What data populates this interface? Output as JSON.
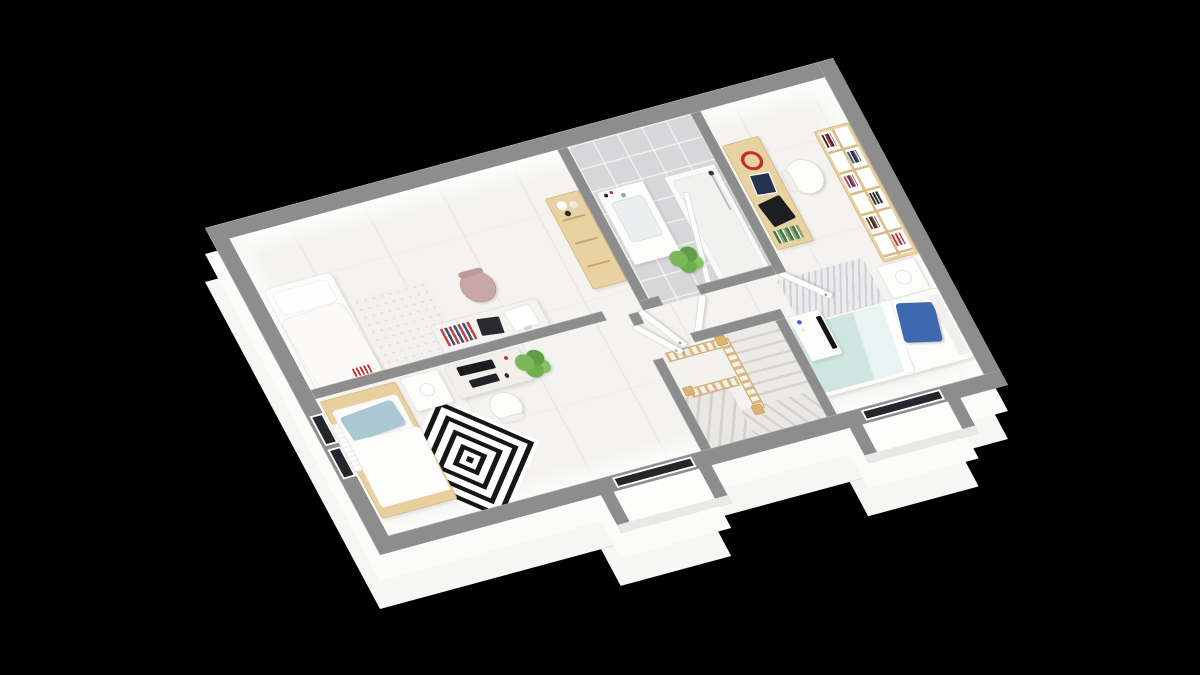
{
  "scene": {
    "type": "3d-isometric-floorplan-render",
    "background": "#000000",
    "storey": "upper floor with stairwell",
    "text_visible": "none"
  },
  "palette": {
    "bg": "#000000",
    "wall_cap": "#8d8d8d",
    "wall_face": "#ffffff",
    "floor": "#f4f3f0",
    "tile": "#d7d7d9",
    "wood": "#e9d2a2",
    "wood_dark": "#d3ae6e",
    "teal": "#cfe5e0",
    "blue": "#3e68b0",
    "lblue": "#aac8d4",
    "pink": "#c9a7a5",
    "green": "#6fae4e",
    "rug_black": "#161616",
    "glass": "#23262b"
  },
  "rooms": [
    {
      "id": "room-northwest",
      "label": "large room with white day-bed, floral rug, desk with laptop, books and white monitor, pink chair, wooden dresser with vases"
    },
    {
      "id": "bathroom",
      "label": "gray tiled bathroom with white vanity sink and glass shower, potted plant"
    },
    {
      "id": "bedroom-east",
      "label": "bedroom with wooden desk (red headphones, tablet, black laptop), white chair, tall wooden bookshelf, white nightstand with lamp, bed with teal duvet and blue pillow, chevron rug, white TV stand with black TV"
    },
    {
      "id": "bedroom-southwest",
      "label": "bedroom with wooden-frame bed, light blue pillow, black-and-white diamond rug, nightstand with lamp, desk with black monitor and keyboard, white chair, plant, radiator"
    },
    {
      "id": "stairwell",
      "label": "winding staircase with light wooden balustrade"
    },
    {
      "id": "hallway",
      "label": "hallway connecting rooms with four open white doors"
    }
  ],
  "windows": [
    {
      "id": "window-southwest-wall",
      "glass": "#23262b"
    },
    {
      "id": "bay-window-south-left",
      "glass": "#23262b"
    },
    {
      "id": "bay-window-south-right",
      "glass": "#23262b"
    }
  ],
  "doors": [
    {
      "id": "door-room-northwest",
      "state": "open"
    },
    {
      "id": "door-bathroom",
      "state": "open"
    },
    {
      "id": "door-bedroom-southwest",
      "state": "open"
    },
    {
      "id": "door-bedroom-east",
      "state": "open"
    }
  ]
}
